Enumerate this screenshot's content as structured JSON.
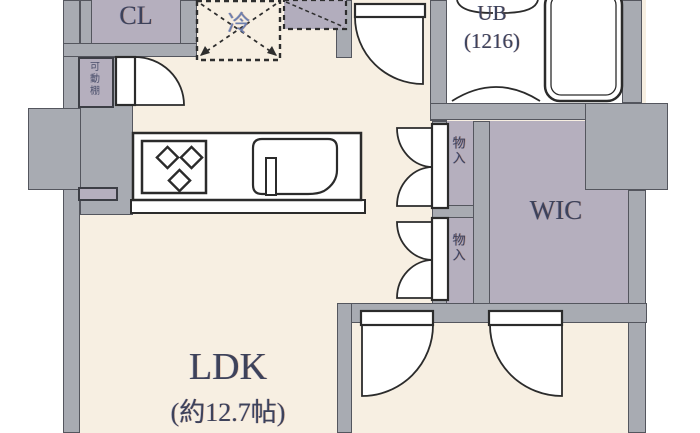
{
  "plan": {
    "title": "apartment-floor-plan",
    "rooms": {
      "ldk": {
        "name": "LDK",
        "size": "(約12.7帖)"
      },
      "cl": {
        "name": "CL"
      },
      "ub": {
        "name": "UB",
        "size": "(1216)"
      },
      "wic": {
        "name": "WIC"
      },
      "storage_upper": {
        "name": "物入"
      },
      "storage_lower": {
        "name": "物入"
      },
      "shelf": {
        "name": "可動棚"
      }
    },
    "appliances": {
      "fridge_label": "冷"
    },
    "icons": [
      "stove-icon",
      "sink-icon",
      "faucet-icon",
      "bathtub-icon",
      "refrigerator-icon",
      "door-swing-icon",
      "bifold-door-icon"
    ],
    "colors": {
      "wall": "#a8abb2",
      "wall_outline": "#54565e",
      "floor_main": "#f7efe2",
      "floor_closet": "#b5afbe",
      "floor_wet": "#ffffff",
      "label_text": "#3d425a",
      "fridge_text": "#6d7fae",
      "line_art": "#2b2b2b"
    }
  }
}
